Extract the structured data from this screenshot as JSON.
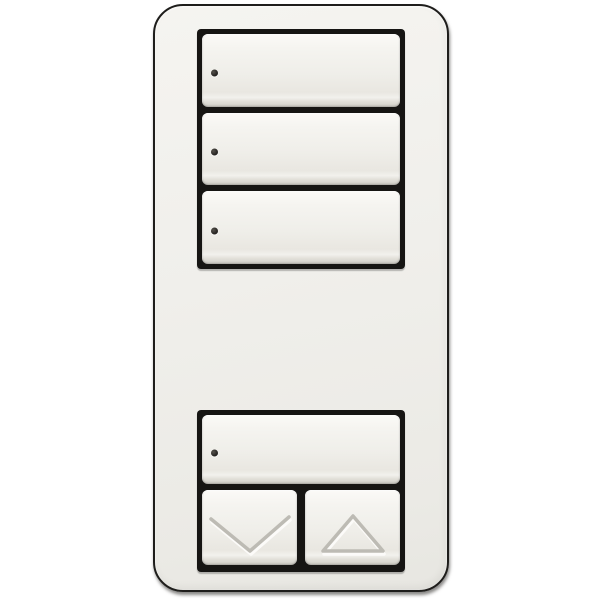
{
  "scene": {
    "description": "white multi-button scene keypad wall light switch, front view, on a plain white background",
    "visible_text": ""
  },
  "device": {
    "type": "scene-keypad-wall-switch",
    "colors": {
      "background": "#ffffff",
      "faceplate": "#f0efeb",
      "faceplate_outline": "#1e1d1b",
      "button_frame": "#161513",
      "button_face_top": "#fbfaf7",
      "button_face_mid": "#efeee9",
      "button_face_low": "#e9e7e1",
      "button_edge": "#d3d1ca",
      "led": "#242220",
      "arrow_shadow": "#bdbbb4",
      "arrow_highlight": "#fcfbf9"
    },
    "top_group": {
      "buttons": [
        {
          "id": "scene-button-1",
          "led_indicator": true
        },
        {
          "id": "scene-button-2",
          "led_indicator": true
        },
        {
          "id": "scene-button-3",
          "led_indicator": true
        }
      ]
    },
    "bottom_group": {
      "buttons": [
        {
          "id": "scene-button-4",
          "led_indicator": true
        }
      ],
      "rocker": [
        {
          "id": "lower-button",
          "icon": "chevron-down-icon"
        },
        {
          "id": "raise-button",
          "icon": "triangle-up-icon"
        }
      ]
    }
  }
}
